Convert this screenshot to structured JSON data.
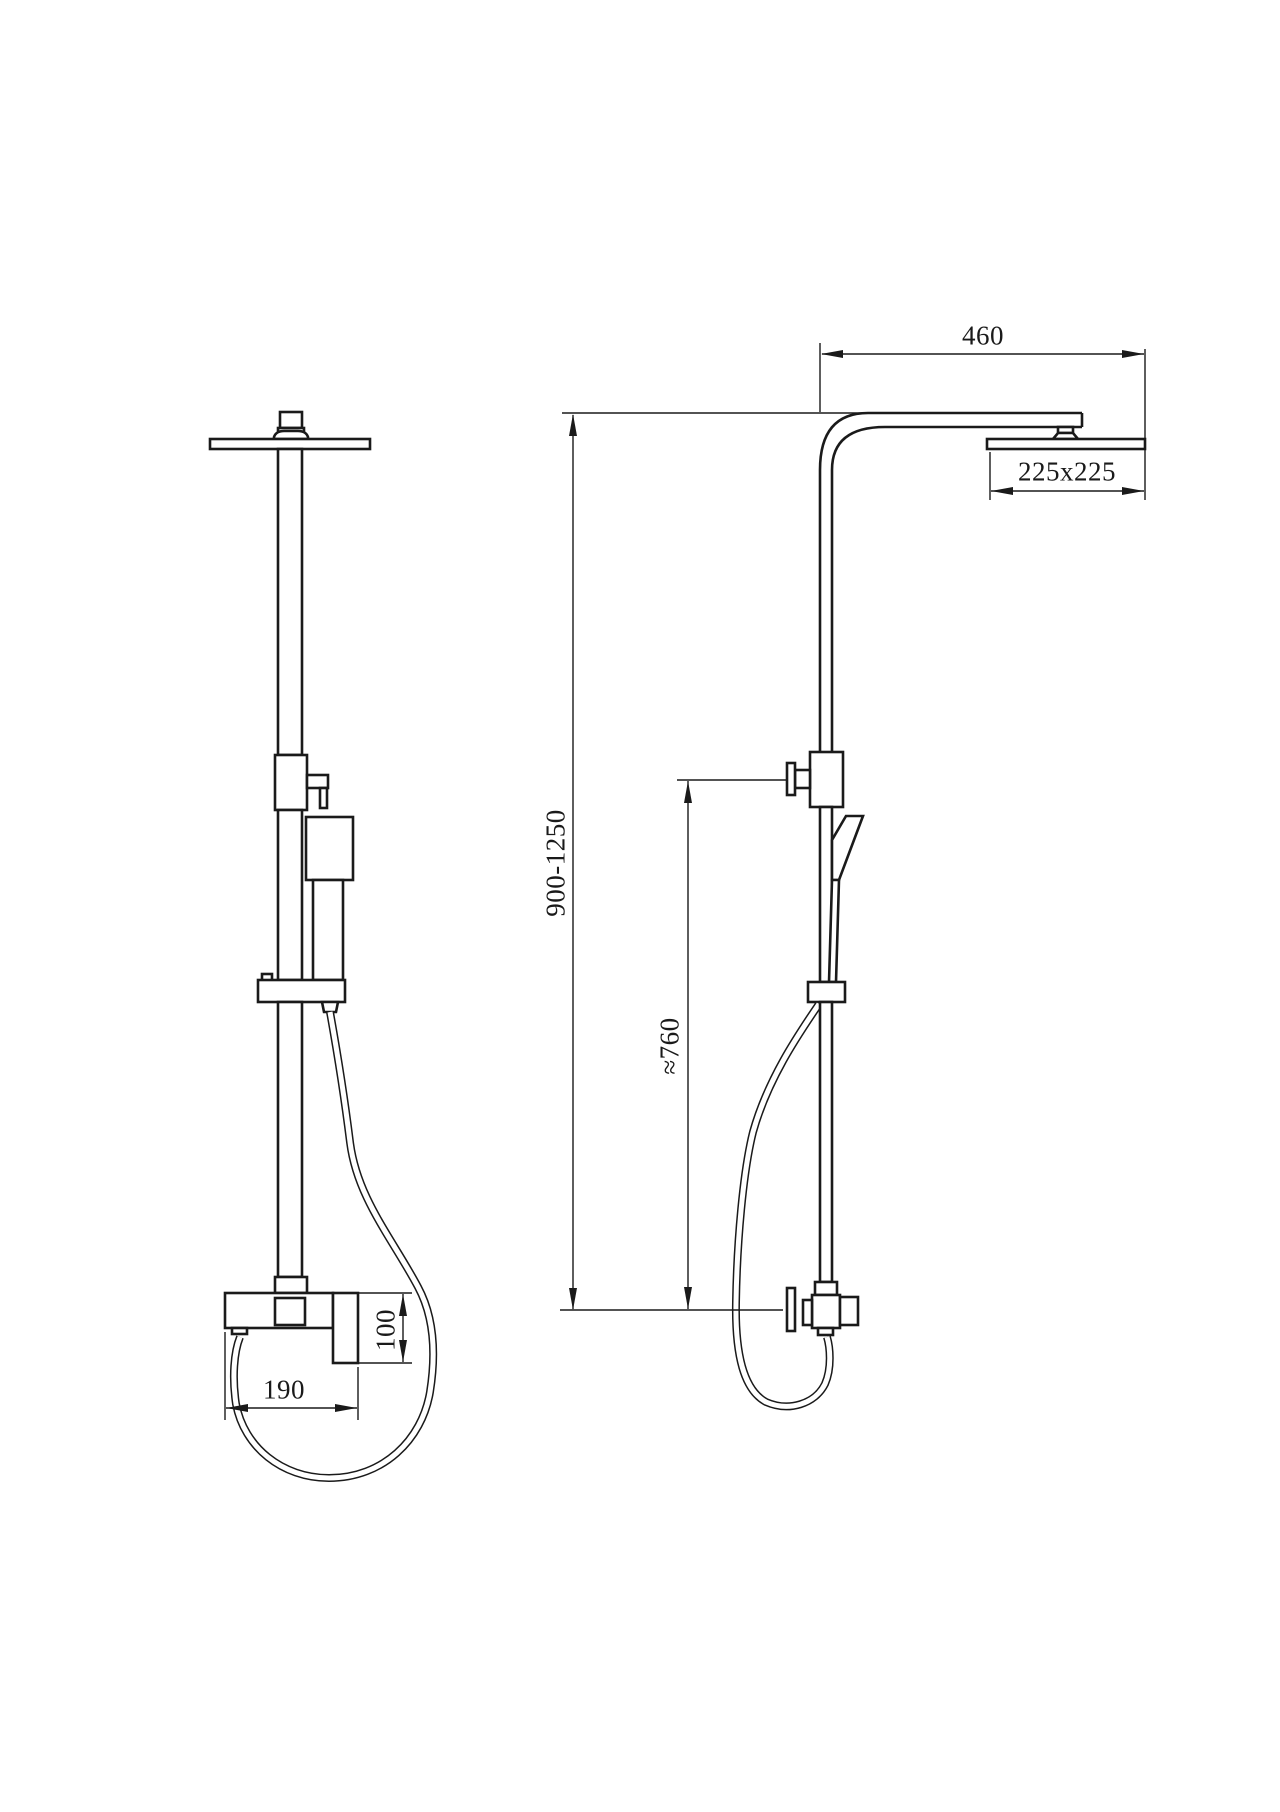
{
  "colors": {
    "background": "#ffffff",
    "line": "#1a1a1a"
  },
  "dimensions": {
    "arm_reach": "460",
    "head_size": "225x225",
    "column_height": "900-1250",
    "handheld_height": "≈760",
    "mixer_height": "100",
    "mixer_width": "190"
  }
}
